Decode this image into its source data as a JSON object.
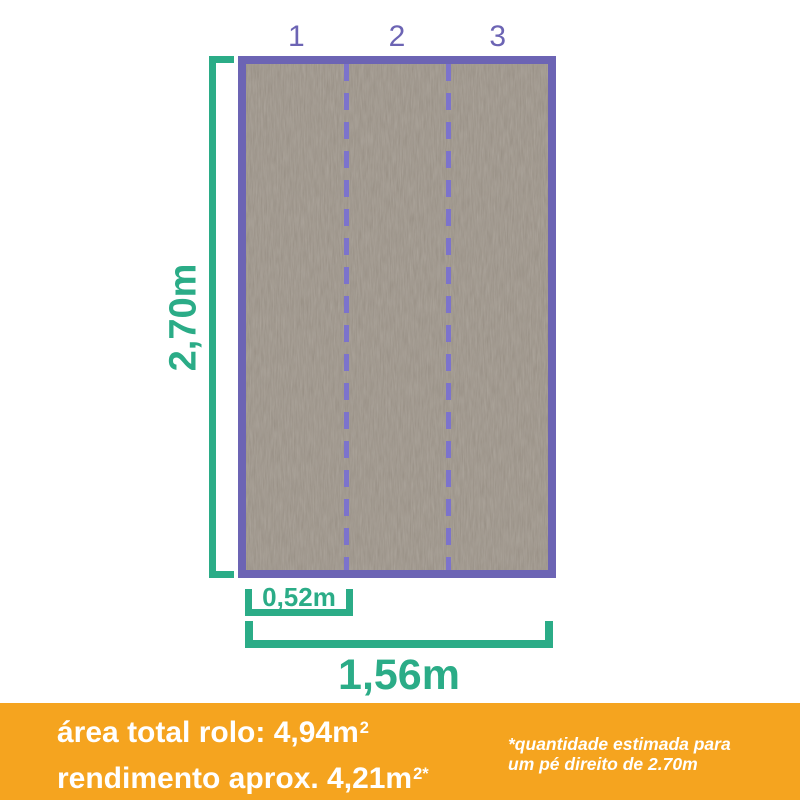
{
  "diagram": {
    "strips_count": 3,
    "strip_labels": [
      "1",
      "2",
      "3"
    ],
    "dimensions": {
      "height_label": "2,70m",
      "strip_width_label": "0,52m",
      "total_width_label": "1,56m"
    }
  },
  "banner": {
    "line1": {
      "text": "área total rolo: 4,94m",
      "sup": "2"
    },
    "line2": {
      "text": "rendimento aprox. 4,21m",
      "sup": "2*"
    },
    "footnote": {
      "line1": "*quantidade estimada para",
      "line2": "um pé direito de 2.70m"
    }
  },
  "colors": {
    "accent_green": "#2BAC87",
    "accent_purple": "#6C64B4",
    "dash_purple": "#7C73CC",
    "banner_orange": "#F5A41F",
    "wallpaper_taupe": "#8D8479",
    "text_white": "#FFFFFF"
  }
}
